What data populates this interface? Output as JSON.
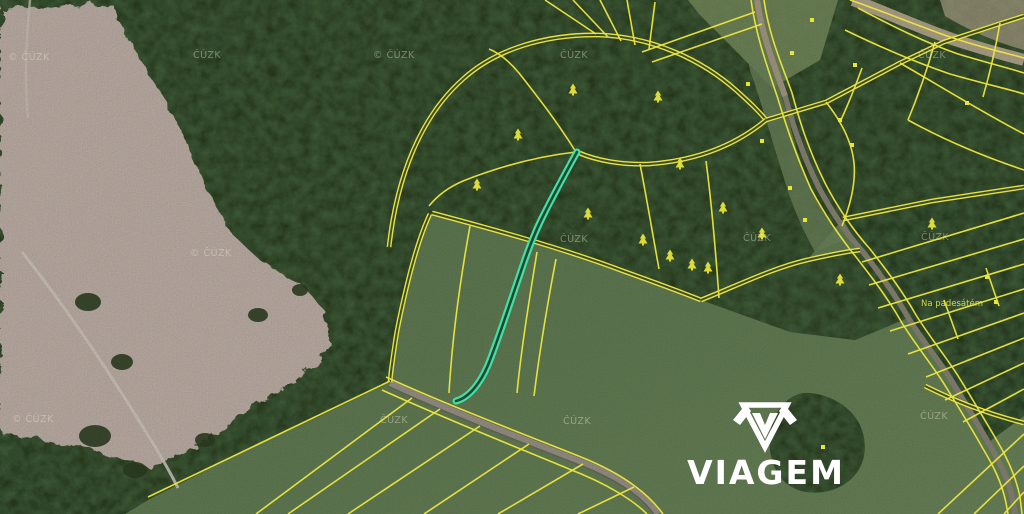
{
  "map": {
    "description": "aerial-cadastral-map",
    "source_watermark": "ČÚZK",
    "watermarks": [
      {
        "x": 8,
        "y": 60,
        "text": "© ČÚZK"
      },
      {
        "x": 193,
        "y": 58,
        "text": "ČÚZK"
      },
      {
        "x": 373,
        "y": 58,
        "text": "© ČÚZK"
      },
      {
        "x": 560,
        "y": 58,
        "text": "ČÚZK"
      },
      {
        "x": 918,
        "y": 58,
        "text": "ČÚZK"
      },
      {
        "x": 190,
        "y": 256,
        "text": "© ČÚZK"
      },
      {
        "x": 560,
        "y": 242,
        "text": "ČÚZK"
      },
      {
        "x": 743,
        "y": 241,
        "text": "ČÚZK"
      },
      {
        "x": 921,
        "y": 240,
        "text": "ČÚZK"
      },
      {
        "x": 12,
        "y": 422,
        "text": "© ČÚZK"
      },
      {
        "x": 380,
        "y": 423,
        "text": "ČÚZK"
      },
      {
        "x": 563,
        "y": 424,
        "text": "ČÚZK"
      },
      {
        "x": 920,
        "y": 419,
        "text": "ČÚZK"
      }
    ],
    "place_label": {
      "text": "Na padesátém",
      "x": 952,
      "y": 306
    },
    "symbols": {
      "trees": [
        {
          "x": 518,
          "y": 133
        },
        {
          "x": 573,
          "y": 88
        },
        {
          "x": 658,
          "y": 95
        },
        {
          "x": 477,
          "y": 183
        },
        {
          "x": 588,
          "y": 212
        },
        {
          "x": 643,
          "y": 238
        },
        {
          "x": 680,
          "y": 162
        },
        {
          "x": 723,
          "y": 206
        },
        {
          "x": 670,
          "y": 254
        },
        {
          "x": 692,
          "y": 263
        },
        {
          "x": 708,
          "y": 266
        },
        {
          "x": 840,
          "y": 278
        },
        {
          "x": 932,
          "y": 222
        },
        {
          "x": 762,
          "y": 232
        }
      ],
      "markers": [
        {
          "x": 812,
          "y": 20
        },
        {
          "x": 792,
          "y": 53
        },
        {
          "x": 748,
          "y": 84
        },
        {
          "x": 762,
          "y": 141
        },
        {
          "x": 855,
          "y": 65
        },
        {
          "x": 967,
          "y": 103
        },
        {
          "x": 840,
          "y": 120
        },
        {
          "x": 852,
          "y": 145
        },
        {
          "x": 790,
          "y": 188
        },
        {
          "x": 805,
          "y": 220
        },
        {
          "x": 987,
          "y": 277
        },
        {
          "x": 996,
          "y": 302
        },
        {
          "x": 823,
          "y": 447
        }
      ]
    },
    "colors": {
      "parcel_line": "#ece73d",
      "highlighted_parcel": "#3ce3a4",
      "forest": "#263518",
      "meadow": "#5e7a50",
      "cleared_land": "#c3b3a8",
      "road": "#8d897b",
      "symbol": "#e8e43a",
      "watermark": "#e9e7c8",
      "place_label": "#e6e44a",
      "logo": "#ffffff"
    }
  },
  "branding": {
    "logo_text": "VIAGEM",
    "logo_icon": "viagem-gem-icon"
  }
}
